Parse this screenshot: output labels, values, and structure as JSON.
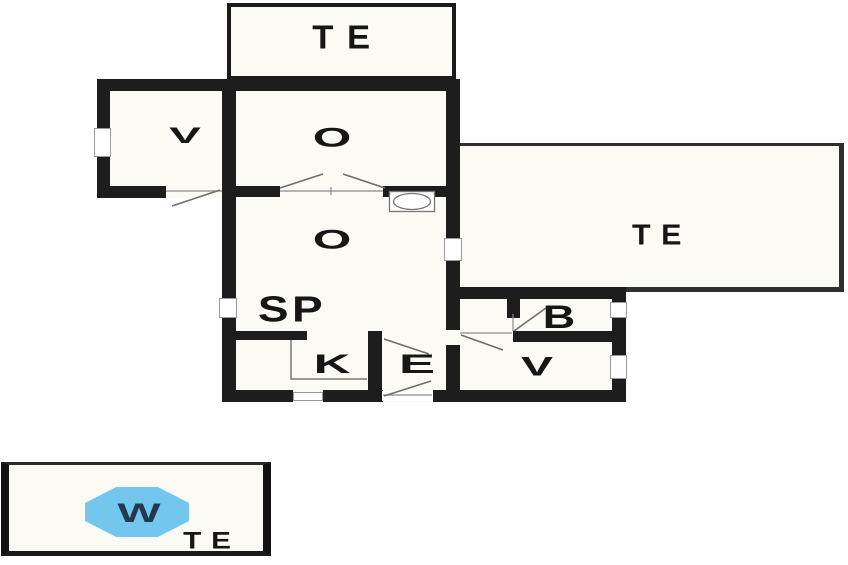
{
  "plan": {
    "rooms": [
      {
        "id": "te-top",
        "label": "TE"
      },
      {
        "id": "v-topleft",
        "label": "V"
      },
      {
        "id": "o-upper",
        "label": "O"
      },
      {
        "id": "o-lower",
        "label": "O"
      },
      {
        "id": "te-right",
        "label": "TE"
      },
      {
        "id": "sp",
        "label": "SP"
      },
      {
        "id": "k",
        "label": "K"
      },
      {
        "id": "e",
        "label": "E"
      },
      {
        "id": "b",
        "label": "B"
      },
      {
        "id": "v-right",
        "label": "V"
      }
    ],
    "legend": {
      "water_label": "W",
      "terrace_label": "TE"
    },
    "colors": {
      "wall": "#1d1d1d",
      "thin_outline": "#2f2f2f",
      "detail_line": "#6e6e6e",
      "room_fill": "#fbfaf4",
      "water": "#73c6ee",
      "water_text": "#25394e",
      "label_ink": "#161616"
    }
  }
}
